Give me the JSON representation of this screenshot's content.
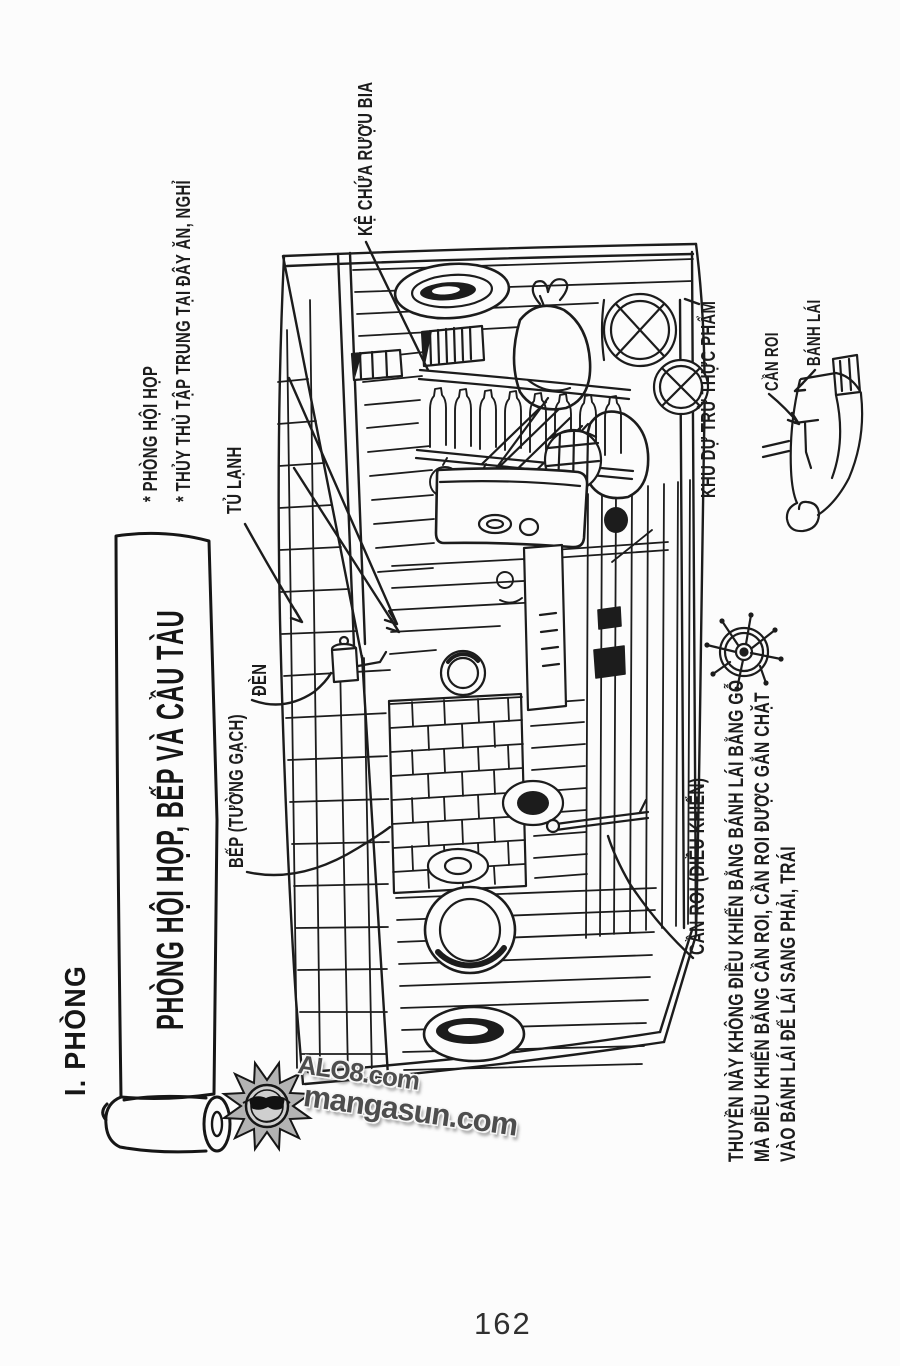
{
  "page": {
    "number": "162"
  },
  "title": {
    "section": "I. PHÒNG",
    "banner": "PHÒNG HỘI HỌP, BẾP VÀ CẦU TÀU"
  },
  "labels": {
    "ke_chua_ruou_bia": "KỆ CHỨA RƯỢU BIA",
    "phong_hoi_hop": "* PHÒNG HỘI HỌP",
    "thuy_thu_tap_trung": "* THỦY THỦ TẬP TRUNG TẠI ĐÂY ĂN, NGHỈ",
    "tu_lanh": "TỦ LẠNH",
    "den": "ĐÈN",
    "bep_tuong_gach": "BẾP (TƯỜNG GẠCH)",
    "khu_du_tru_thuc_pham": "KHU DỰ TRỮ THỰC PHẨM",
    "can_roi": "CẦN ROI",
    "banh_lai": "BÁNH LÁI",
    "can_roi_dieu_khien": "CẦN ROI (ĐIỀU KHIỂN)"
  },
  "footnote": {
    "line1": "THUYỀN NÀY KHÔNG ĐIỀU KHIỂN BẰNG BÁNH LÁI BẰNG GỖ",
    "line2": "MÀ ĐIỀU KHIỂN BẰNG CẦN ROI, CẦN ROI ĐƯỢC GẮN CHẶT",
    "line3": "VÀO BÁNH LÁI ĐỂ LÁI SANG PHẢI, TRÁI"
  },
  "watermark": {
    "line1": "ALO8.com",
    "line2": "mangasun.com"
  },
  "colors": {
    "ink": "#1c1c1c",
    "paper": "#fcfcfc",
    "watermark_gray": "#4d4d4d"
  }
}
